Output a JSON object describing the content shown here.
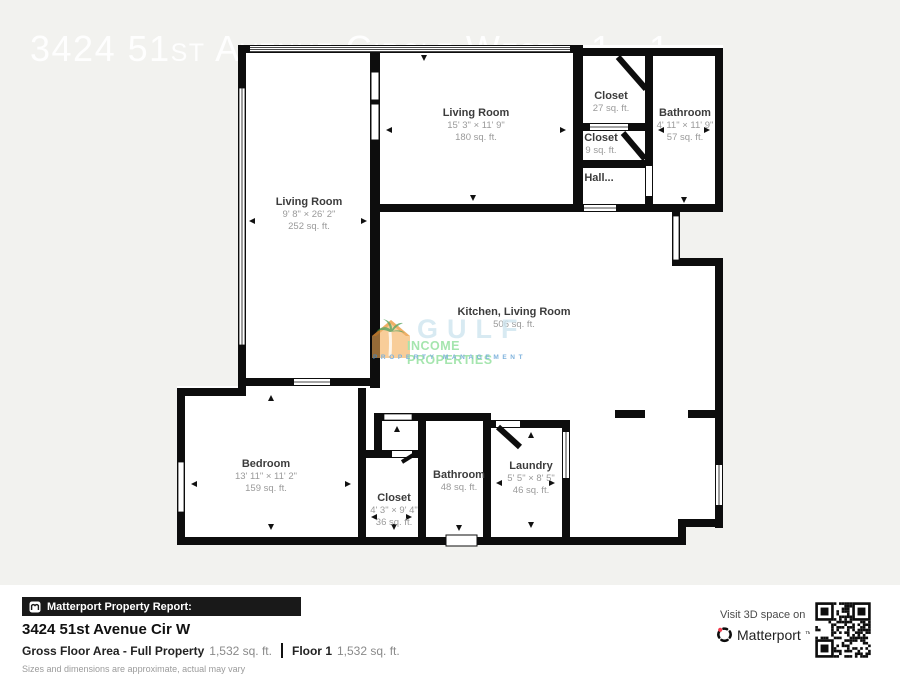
{
  "watermarks": {
    "top_title": "3424 51st Avenue Circle West - 1 - 1",
    "bottom_call": "Call or text 941 559 8",
    "logo": {
      "line1": "GULF",
      "line2": "INCOME PROPERTIES",
      "line3": "PROPERTY MANAGEMENT"
    }
  },
  "floorplan": {
    "rooms": {
      "living_room_left": {
        "name": "Living Room",
        "dims": "9' 8\" × 26' 2\"",
        "area": "252 sq. ft."
      },
      "living_room_top": {
        "name": "Living Room",
        "dims": "15' 3\" × 11' 9\"",
        "area": "180 sq. ft."
      },
      "closet_27": {
        "name": "Closet",
        "area": "27 sq. ft."
      },
      "bathroom_top": {
        "name": "Bathroom",
        "dims": "4' 11\" × 11' 9\"",
        "area": "57 sq. ft."
      },
      "closet_9": {
        "name": "Closet",
        "area": "9 sq. ft."
      },
      "hall": {
        "name": "Hall..."
      },
      "kitchen_living": {
        "name": "Kitchen, Living Room",
        "area": "506 sq. ft."
      },
      "bedroom": {
        "name": "Bedroom",
        "dims": "13' 11\" × 11' 2\"",
        "area": "159 sq. ft."
      },
      "closet_36": {
        "name": "Closet",
        "dims": "4' 3\" × 9' 4\"",
        "area": "36 sq. ft."
      },
      "bathroom_48": {
        "name": "Bathroom",
        "area": "48 sq. ft."
      },
      "laundry": {
        "name": "Laundry",
        "dims": "5' 5\" × 8' 5\"",
        "area": "46 sq. ft."
      }
    }
  },
  "report": {
    "bar_label": "Matterport Property Report:",
    "address": "3424 51st Avenue Cir W",
    "gross_label": "Gross Floor Area - Full Property",
    "gross_value": "1,532 sq. ft.",
    "floor_label": "Floor 1",
    "floor_value": "1,532 sq. ft.",
    "disclaimer": "Sizes and dimensions are approximate, actual may vary"
  },
  "cta": {
    "visit_label": "Visit 3D space on",
    "brand": "Matterport",
    "trademark": "™"
  },
  "colors": {
    "walls": "#0d0d0d",
    "page_bg": "#f2f2ef",
    "gulf_blue": "#cfe6f0",
    "gulf_green": "#8fdf9b",
    "gulf_mgmt_blue": "#5e9fd4"
  }
}
